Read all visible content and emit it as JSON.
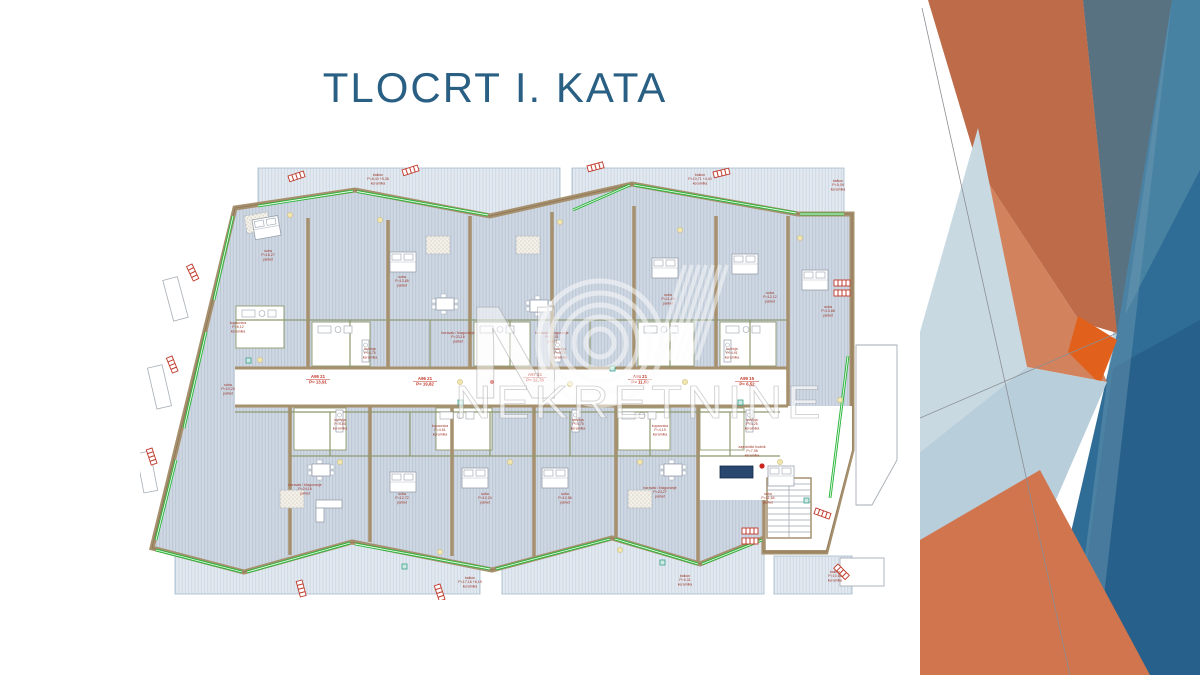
{
  "slide": {
    "title": "TLOCRT I. KATA"
  },
  "watermark": {
    "letter": "N",
    "brand": "NEKRETNINE"
  },
  "palette": {
    "title_text": "#2a5f84",
    "plan_wall": "#a6906d",
    "plan_floor_fill": "#cfd8e3",
    "plan_glazing_green": "#2db53c",
    "plan_annotation_red": "#b03a2e",
    "deco_orange": "#bd6b49",
    "deco_orange_bright": "#e1601c",
    "deco_slate": "#587281",
    "deco_blue": "#2f6d96",
    "deco_light_blue": "#bcd0dc"
  },
  "floor_plan": {
    "units": [
      {
        "x": 178,
        "y": 218,
        "code": "A95  21",
        "area": "P= 13,91"
      },
      {
        "x": 285,
        "y": 220,
        "code": "A96  21",
        "area": "P= 19,82"
      },
      {
        "x": 395,
        "y": 216,
        "code": "A97  21",
        "area": "P= 12,76"
      },
      {
        "x": 500,
        "y": 218,
        "code": "A98  21",
        "area": "P= 11,90"
      },
      {
        "x": 607,
        "y": 220,
        "code": "A99  15",
        "area": "P= 6,52"
      }
    ],
    "rooms": [
      {
        "x": 238,
        "y": 16,
        "lines": [
          "balkon",
          "P=8,43 +5,38",
          "keramika"
        ]
      },
      {
        "x": 560,
        "y": 16,
        "lines": [
          "balkon",
          "P=10,71 +4,40",
          "keramika"
        ]
      },
      {
        "x": 698,
        "y": 22,
        "lines": [
          "balkon",
          "P=5,09",
          "keramika"
        ]
      },
      {
        "x": 128,
        "y": 92,
        "lines": [
          "soba",
          "P=16,27",
          "parket"
        ]
      },
      {
        "x": 262,
        "y": 118,
        "lines": [
          "soba",
          "P=13,65",
          "parket"
        ]
      },
      {
        "x": 318,
        "y": 174,
        "lines": [
          "boravak / blagovanje",
          "P=23,16",
          "parket"
        ]
      },
      {
        "x": 412,
        "y": 174,
        "lines": [
          "boravak / blagovanje",
          "P=21,01",
          "parket"
        ]
      },
      {
        "x": 528,
        "y": 136,
        "lines": [
          "soba",
          "P=11,45",
          "parket"
        ]
      },
      {
        "x": 630,
        "y": 134,
        "lines": [
          "soba",
          "P=12,12",
          "parket"
        ]
      },
      {
        "x": 688,
        "y": 148,
        "lines": [
          "soba",
          "P=13,88",
          "parket"
        ]
      },
      {
        "x": 98,
        "y": 164,
        "lines": [
          "kupaonica",
          "P=5,12",
          "keramika"
        ]
      },
      {
        "x": 88,
        "y": 226,
        "lines": [
          "soba",
          "P=10,20",
          "parket"
        ]
      },
      {
        "x": 230,
        "y": 190,
        "lines": [
          "kuhinja",
          "P=4,75",
          "keramika"
        ]
      },
      {
        "x": 420,
        "y": 190,
        "lines": [
          "kuhinja",
          "P=4,75",
          "keramika"
        ]
      },
      {
        "x": 592,
        "y": 190,
        "lines": [
          "kuhinja",
          "P=4,91",
          "keramika"
        ]
      },
      {
        "x": 200,
        "y": 261,
        "lines": [
          "kuhinja",
          "P=4,80",
          "keramika"
        ]
      },
      {
        "x": 438,
        "y": 261,
        "lines": [
          "kuhinja",
          "P=4,75",
          "keramika"
        ]
      },
      {
        "x": 612,
        "y": 261,
        "lines": [
          "kuhinja",
          "P=4,25",
          "keramika"
        ]
      },
      {
        "x": 300,
        "y": 267,
        "lines": [
          "kupaonica",
          "P=4,61",
          "keramika"
        ]
      },
      {
        "x": 520,
        "y": 267,
        "lines": [
          "kupaonica",
          "P=4,19",
          "keramika"
        ]
      },
      {
        "x": 165,
        "y": 326,
        "lines": [
          "boravak / blagovanje",
          "P=24,16",
          "parket"
        ]
      },
      {
        "x": 262,
        "y": 335,
        "lines": [
          "soba",
          "P=12,72",
          "parket"
        ]
      },
      {
        "x": 345,
        "y": 335,
        "lines": [
          "soba",
          "P=12,24",
          "parket"
        ]
      },
      {
        "x": 425,
        "y": 335,
        "lines": [
          "soba",
          "P=12,56",
          "parket"
        ]
      },
      {
        "x": 520,
        "y": 329,
        "lines": [
          "boravak / blagovanje",
          "P=23,27",
          "parket"
        ]
      },
      {
        "x": 628,
        "y": 335,
        "lines": [
          "soba",
          "P=11,64",
          "parket"
        ]
      },
      {
        "x": 330,
        "y": 419,
        "lines": [
          "balkon",
          "P=17,16 +6,19",
          "keramika"
        ]
      },
      {
        "x": 545,
        "y": 417,
        "lines": [
          "balkon",
          "P=9,31",
          "keramika"
        ]
      },
      {
        "x": 695,
        "y": 413,
        "lines": [
          "balkon",
          "P=10,65",
          "keramika"
        ]
      },
      {
        "x": 612,
        "y": 288,
        "lines": [
          "zajednički hodnik",
          "P=7,98",
          "keramika"
        ]
      }
    ]
  }
}
